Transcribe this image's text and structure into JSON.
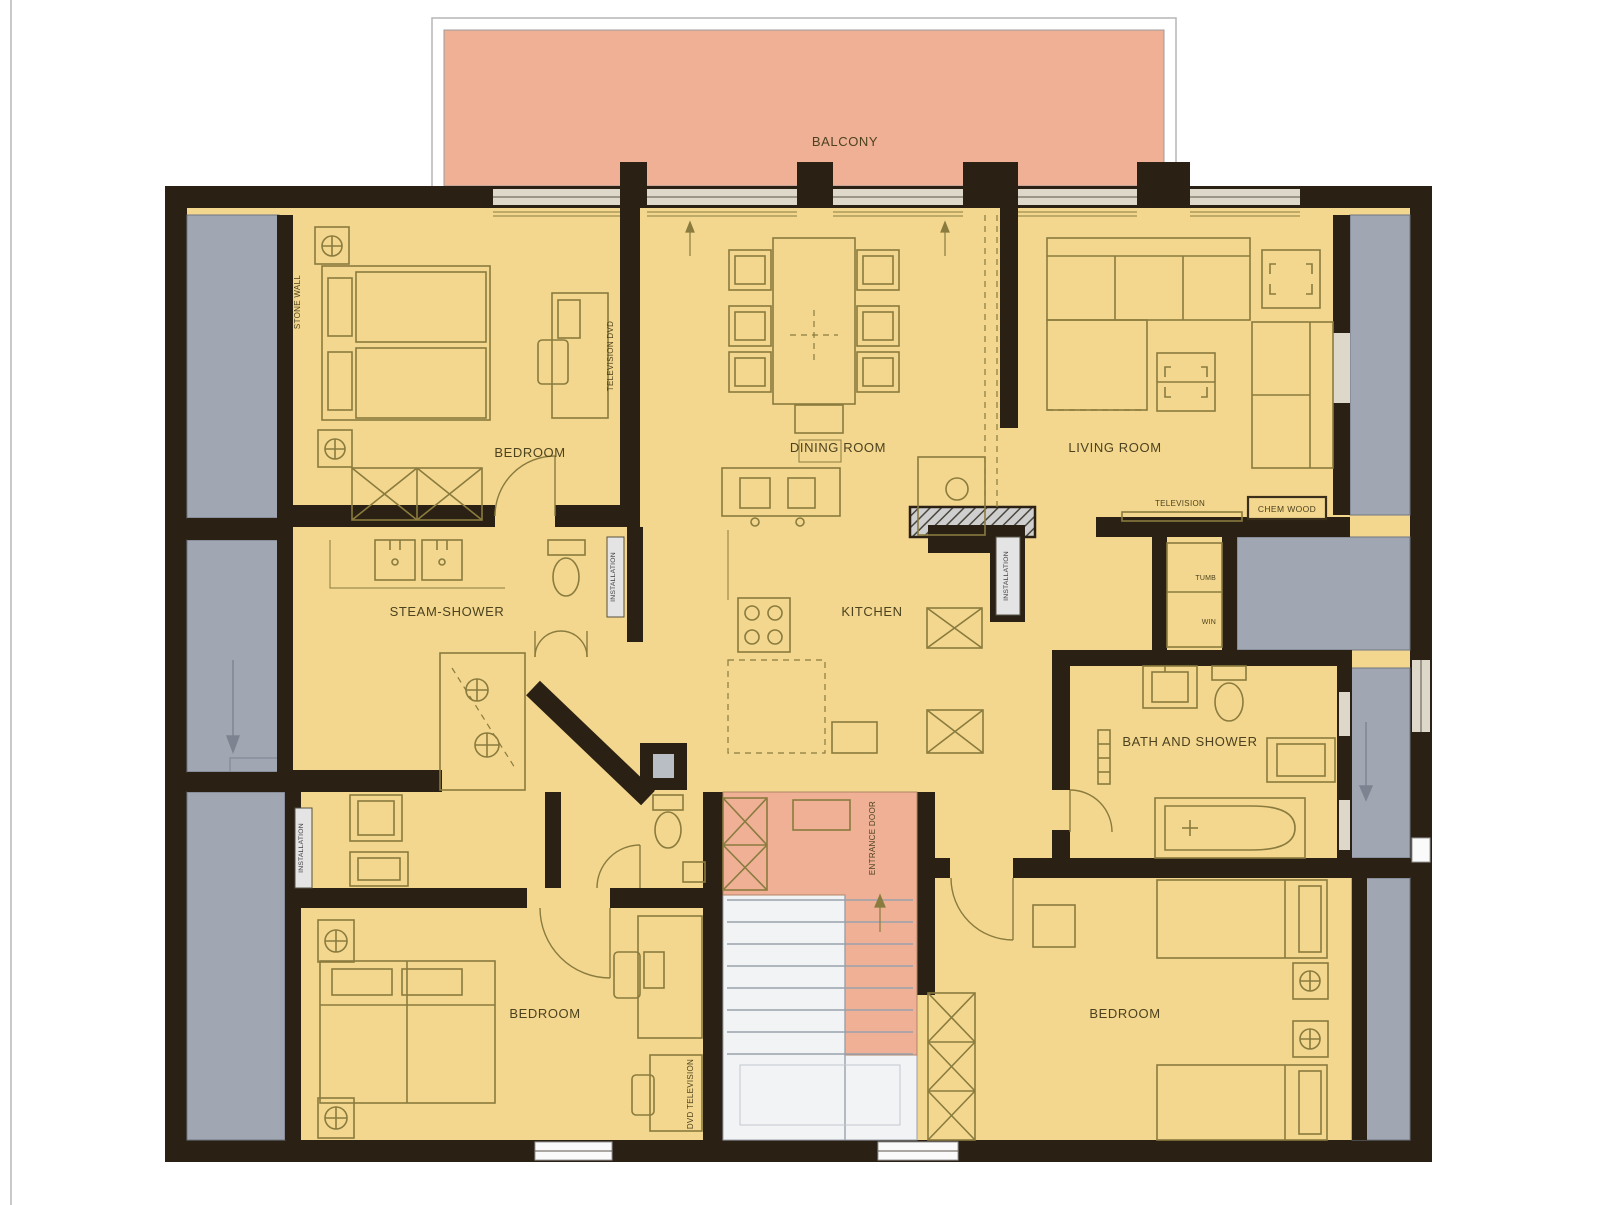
{
  "colors": {
    "wall": "#2a2014",
    "room_fill": "#f3d78e",
    "balcony_fill": "#efb096",
    "entrance_fill": "#efb096",
    "roof_space_gray": "#a0a6b2",
    "furniture_line": "#8a7b3e",
    "stairs_fill": "#f2f3f5",
    "window_fill": "#ded8cb",
    "installation_box": "#e4e4e4"
  },
  "rooms": {
    "balcony": {
      "label": "BALCONY"
    },
    "bedroom_top_left": {
      "label": "BEDROOM"
    },
    "dining_room": {
      "label": "DINING ROOM"
    },
    "living_room": {
      "label": "LIVING ROOM"
    },
    "steam_shower": {
      "label": "STEAM-SHOWER"
    },
    "kitchen": {
      "label": "KITCHEN"
    },
    "bath_and_shower": {
      "label": "BATH AND SHOWER"
    },
    "bedroom_bottom_left": {
      "label": "BEDROOM"
    },
    "bedroom_bottom_right": {
      "label": "BEDROOM"
    }
  },
  "annotations": {
    "entrance_door": "ENTRANCE DOOR",
    "stone_wall": "STONE WALL",
    "installation": "INSTALLATION",
    "television": "TELEVISION",
    "television_dvd": "TELEVISION DVD",
    "dvd_television": "DVD TELEVISION",
    "chem_wood": "CHEM WOOD",
    "tumb": "TUMB",
    "win": "WIN"
  }
}
